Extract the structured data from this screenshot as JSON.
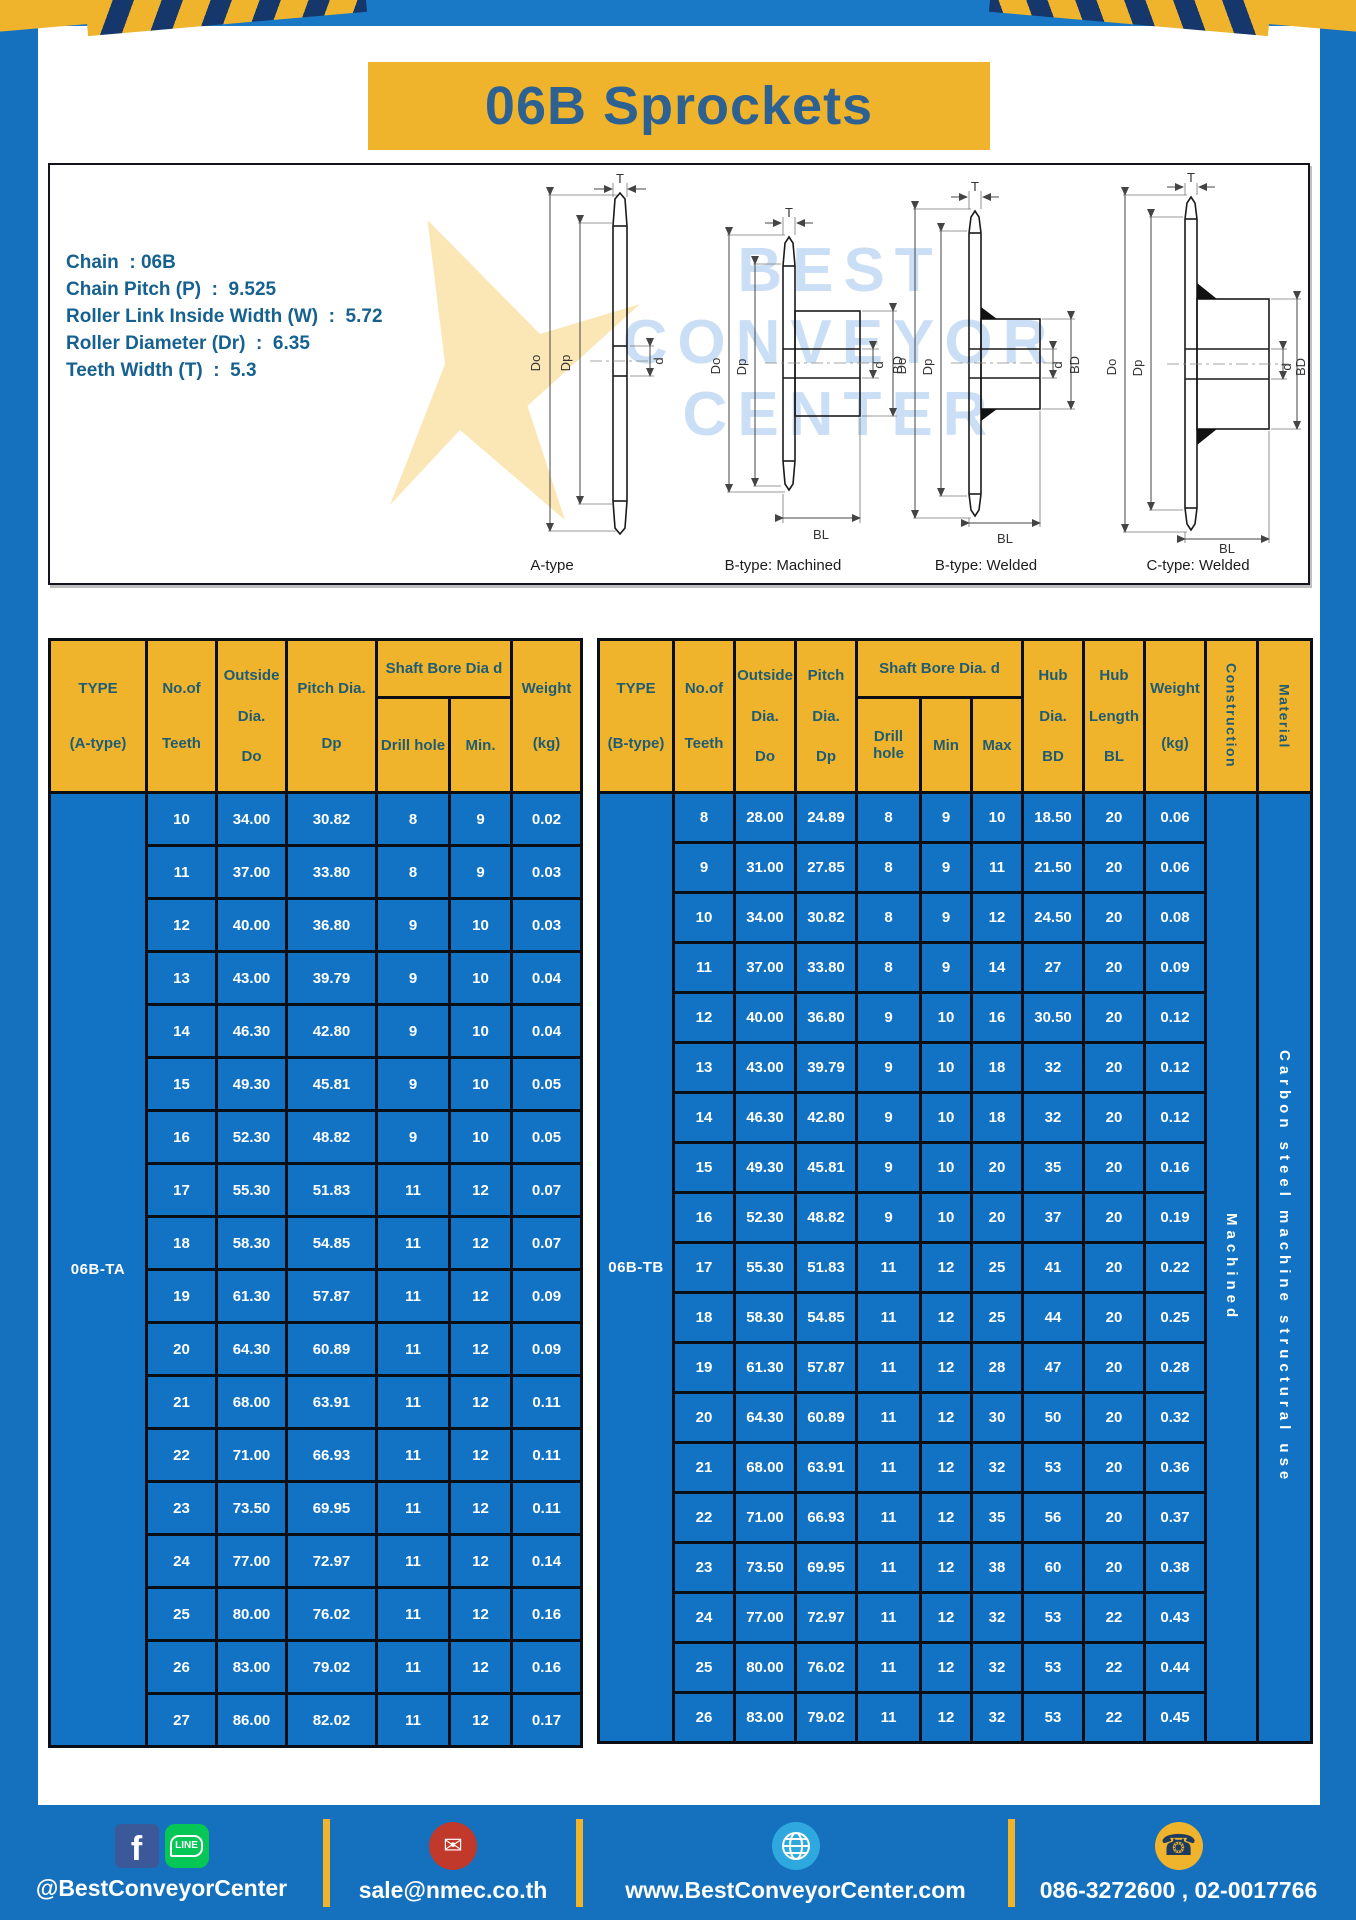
{
  "title": "06B Sprockets",
  "specs": {
    "chain": "Chain  : 06B",
    "pitch": "Chain Pitch (P)  :  9.525",
    "roller_width": "Roller Link Inside Width (W)  :  5.72",
    "roller_dia": "Roller Diameter (Dr)  :  6.35",
    "teeth_width": "Teeth Width (T)  :  5.3"
  },
  "drawings": {
    "watermark_lines": [
      "BEST",
      "CONVEYOR",
      "CENTER"
    ],
    "labels": {
      "a": "A-type",
      "b_machined": "B-type: Machined",
      "b_welded": "B-type: Welded",
      "c_welded": "C-type: Welded"
    },
    "dims": {
      "t": "T",
      "doo": "Do",
      "dp": "Dp",
      "d": "d",
      "bd": "BD",
      "bl": "BL"
    }
  },
  "table_a": {
    "type_label": "06B-TA",
    "h": {
      "type1": "TYPE",
      "type2": "(A-type)",
      "teeth1": "No.of",
      "teeth2": "Teeth",
      "out1": "Outside",
      "out2": "Dia.",
      "out3": "Do",
      "pitch1": "Pitch Dia.",
      "pitch2": "Dp",
      "bore": "Shaft Bore Dia d",
      "drill": "Drill hole",
      "min": "Min.",
      "w1": "Weight",
      "w2": "(kg)"
    },
    "rows": [
      [
        "10",
        "34.00",
        "30.82",
        "8",
        "9",
        "0.02"
      ],
      [
        "11",
        "37.00",
        "33.80",
        "8",
        "9",
        "0.03"
      ],
      [
        "12",
        "40.00",
        "36.80",
        "9",
        "10",
        "0.03"
      ],
      [
        "13",
        "43.00",
        "39.79",
        "9",
        "10",
        "0.04"
      ],
      [
        "14",
        "46.30",
        "42.80",
        "9",
        "10",
        "0.04"
      ],
      [
        "15",
        "49.30",
        "45.81",
        "9",
        "10",
        "0.05"
      ],
      [
        "16",
        "52.30",
        "48.82",
        "9",
        "10",
        "0.05"
      ],
      [
        "17",
        "55.30",
        "51.83",
        "11",
        "12",
        "0.07"
      ],
      [
        "18",
        "58.30",
        "54.85",
        "11",
        "12",
        "0.07"
      ],
      [
        "19",
        "61.30",
        "57.87",
        "11",
        "12",
        "0.09"
      ],
      [
        "20",
        "64.30",
        "60.89",
        "11",
        "12",
        "0.09"
      ],
      [
        "21",
        "68.00",
        "63.91",
        "11",
        "12",
        "0.11"
      ],
      [
        "22",
        "71.00",
        "66.93",
        "11",
        "12",
        "0.11"
      ],
      [
        "23",
        "73.50",
        "69.95",
        "11",
        "12",
        "0.11"
      ],
      [
        "24",
        "77.00",
        "72.97",
        "11",
        "12",
        "0.14"
      ],
      [
        "25",
        "80.00",
        "76.02",
        "11",
        "12",
        "0.16"
      ],
      [
        "26",
        "83.00",
        "79.02",
        "11",
        "12",
        "0.16"
      ],
      [
        "27",
        "86.00",
        "82.02",
        "11",
        "12",
        "0.17"
      ]
    ]
  },
  "table_b": {
    "type_label": "06B-TB",
    "construction": "Machined",
    "material": "Carbon steel machine structural use",
    "h": {
      "type1": "TYPE",
      "type2": "(B-type)",
      "teeth1": "No.of",
      "teeth2": "Teeth",
      "out1": "Outside",
      "out2": "Dia.",
      "out3": "Do",
      "pitch1": "Pitch",
      "pitch2": "Dia.",
      "pitch3": "Dp",
      "bore": "Shaft Bore Dia.  d",
      "drill": "Drill hole",
      "min": "Min",
      "max": "Max",
      "hubd1": "Hub",
      "hubd2": "Dia.",
      "hubd3": "BD",
      "hubl1": "Hub",
      "hubl2": "Length",
      "hubl3": "BL",
      "w1": "Weight",
      "w2": "(kg)",
      "construction": "Construction",
      "material": "Material"
    },
    "rows": [
      [
        "8",
        "28.00",
        "24.89",
        "8",
        "9",
        "10",
        "18.50",
        "20",
        "0.06"
      ],
      [
        "9",
        "31.00",
        "27.85",
        "8",
        "9",
        "11",
        "21.50",
        "20",
        "0.06"
      ],
      [
        "10",
        "34.00",
        "30.82",
        "8",
        "9",
        "12",
        "24.50",
        "20",
        "0.08"
      ],
      [
        "11",
        "37.00",
        "33.80",
        "8",
        "9",
        "14",
        "27",
        "20",
        "0.09"
      ],
      [
        "12",
        "40.00",
        "36.80",
        "9",
        "10",
        "16",
        "30.50",
        "20",
        "0.12"
      ],
      [
        "13",
        "43.00",
        "39.79",
        "9",
        "10",
        "18",
        "32",
        "20",
        "0.12"
      ],
      [
        "14",
        "46.30",
        "42.80",
        "9",
        "10",
        "18",
        "32",
        "20",
        "0.12"
      ],
      [
        "15",
        "49.30",
        "45.81",
        "9",
        "10",
        "20",
        "35",
        "20",
        "0.16"
      ],
      [
        "16",
        "52.30",
        "48.82",
        "9",
        "10",
        "20",
        "37",
        "20",
        "0.19"
      ],
      [
        "17",
        "55.30",
        "51.83",
        "11",
        "12",
        "25",
        "41",
        "20",
        "0.22"
      ],
      [
        "18",
        "58.30",
        "54.85",
        "11",
        "12",
        "25",
        "44",
        "20",
        "0.25"
      ],
      [
        "19",
        "61.30",
        "57.87",
        "11",
        "12",
        "28",
        "47",
        "20",
        "0.28"
      ],
      [
        "20",
        "64.30",
        "60.89",
        "11",
        "12",
        "30",
        "50",
        "20",
        "0.32"
      ],
      [
        "21",
        "68.00",
        "63.91",
        "11",
        "12",
        "32",
        "53",
        "20",
        "0.36"
      ],
      [
        "22",
        "71.00",
        "66.93",
        "11",
        "12",
        "35",
        "56",
        "20",
        "0.37"
      ],
      [
        "23",
        "73.50",
        "69.95",
        "11",
        "12",
        "38",
        "60",
        "20",
        "0.38"
      ],
      [
        "24",
        "77.00",
        "72.97",
        "11",
        "12",
        "32",
        "53",
        "22",
        "0.43"
      ],
      [
        "25",
        "80.00",
        "76.02",
        "11",
        "12",
        "32",
        "53",
        "22",
        "0.44"
      ],
      [
        "26",
        "83.00",
        "79.02",
        "11",
        "12",
        "32",
        "53",
        "22",
        "0.45"
      ]
    ]
  },
  "footer": {
    "social_handle": "@BestConveyorCenter",
    "email": "sale@nmec.co.th",
    "website": "www.BestConveyorCenter.com",
    "phones": "086-3272600 , 02-0017766",
    "icons": {
      "fb": "f",
      "line": "LINE",
      "mail": "✉",
      "phone": "☎"
    }
  },
  "colors": {
    "page_blue": "#1571BD",
    "cell_blue": "#1273C5",
    "accent_yellow": "#F0B42C",
    "stripe_navy": "#16376B",
    "title_text": "#2D6191",
    "header_text": "#1F5C74"
  }
}
